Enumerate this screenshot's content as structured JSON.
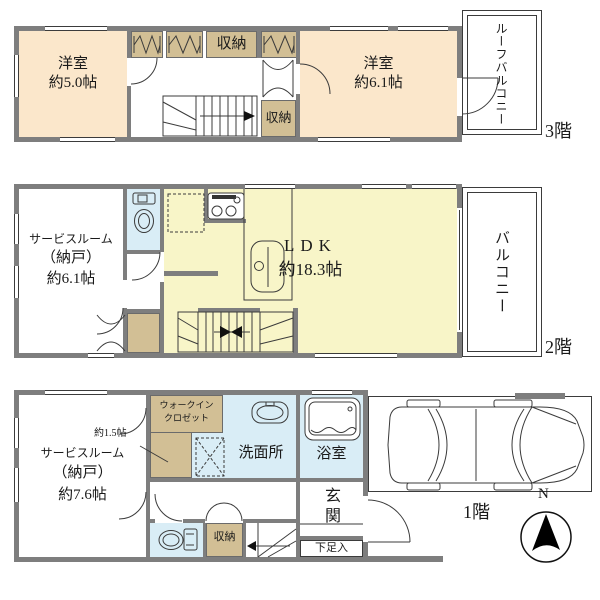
{
  "colors": {
    "wall": "#7e7e7e",
    "room": "#fbe7cb",
    "ldk": "#f8f5c8",
    "water": "#d9edf6",
    "closet": "#d2bf95"
  },
  "floor3": {
    "label": "3階",
    "room_small_name": "洋室",
    "room_small_area": "約5.0帖",
    "room_large_name": "洋室",
    "room_large_area": "約6.1帖",
    "closet_top": "収納",
    "closet_side": "収納",
    "roof_balcony": "ルーフバルコニー"
  },
  "floor2": {
    "label": "2階",
    "service_name": "サービスルーム",
    "service_name2": "（納戸）",
    "service_area": "約6.1帖",
    "ldk_name": "LDK",
    "ldk_area": "約18.3帖",
    "balcony": "バルコニー"
  },
  "floor1": {
    "label": "1階",
    "service_name": "サービスルーム",
    "service_name2": "（納戸）",
    "service_area": "約7.6帖",
    "wic_name1": "ウォークイン",
    "wic_name2": "クロゼット",
    "wic_area": "約1.5帖",
    "washroom": "洗面所",
    "bathroom": "浴室",
    "entrance": "玄関",
    "shoe": "下足入",
    "closet": "収納",
    "compass": "N"
  }
}
